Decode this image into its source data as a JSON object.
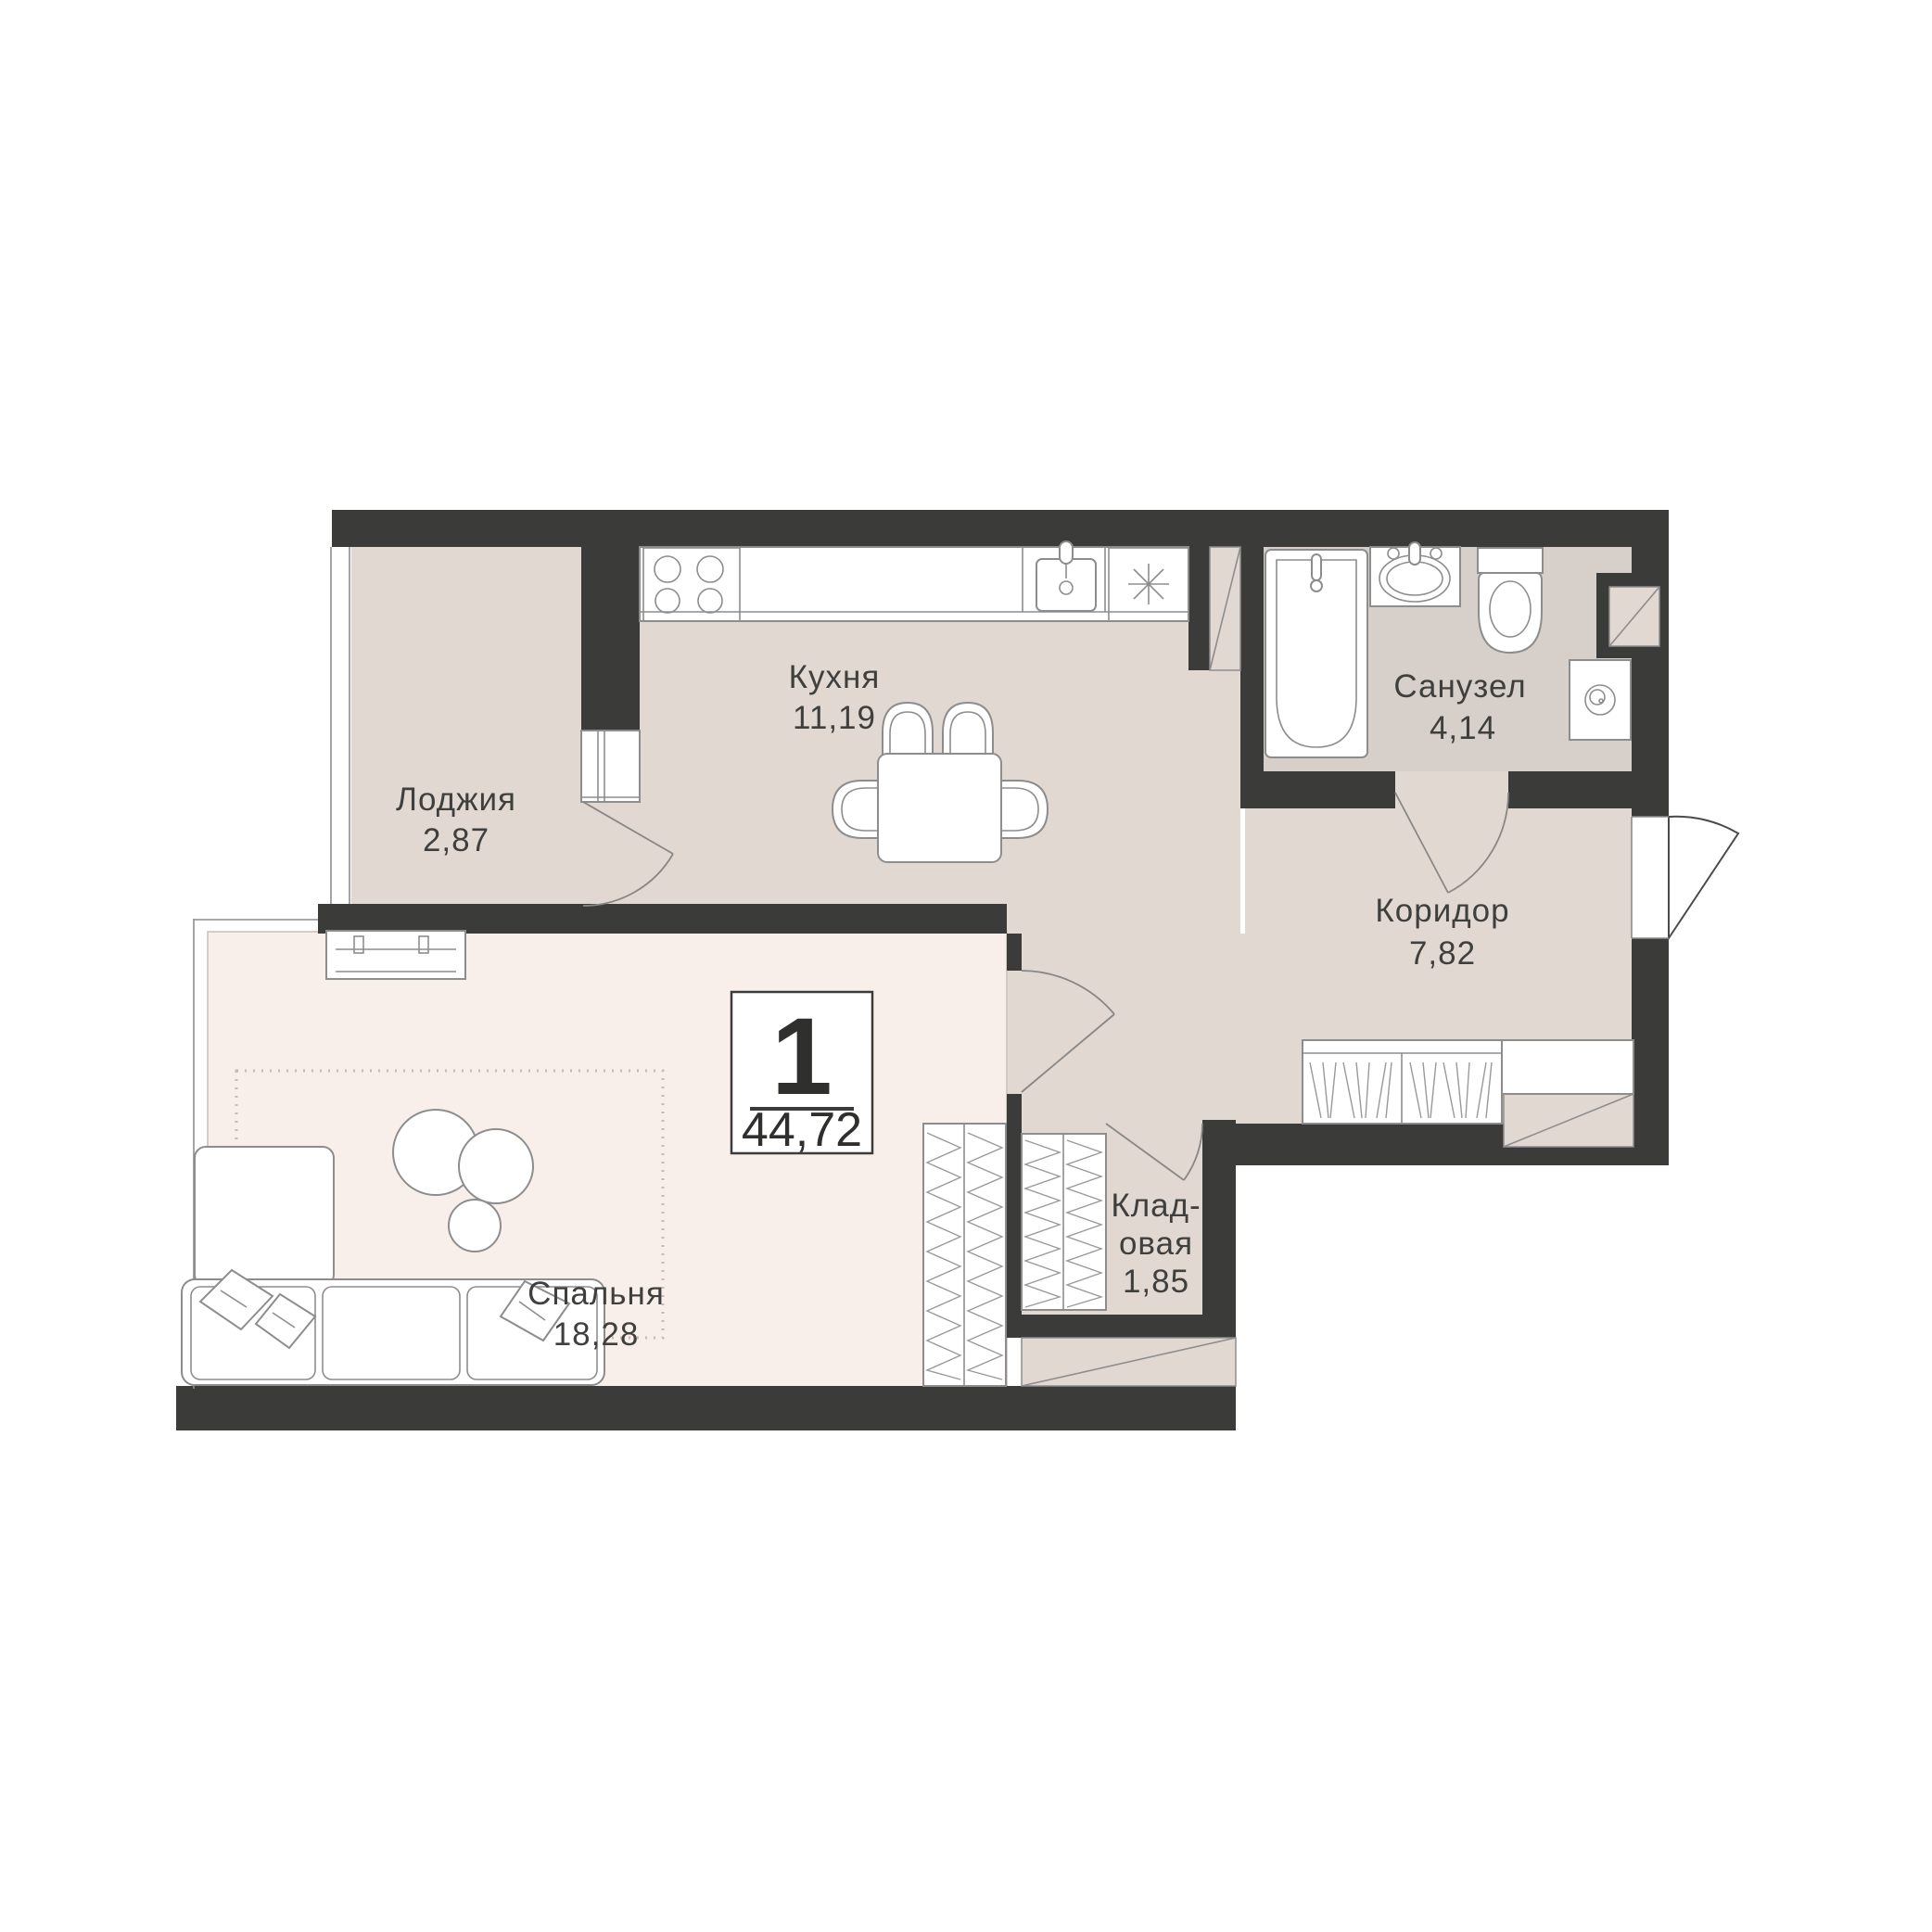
{
  "badge": {
    "room_count": "1",
    "total_area": "44,72"
  },
  "rooms": {
    "kitchen": {
      "label": "Кухня",
      "area": "11,19"
    },
    "loggia": {
      "label": "Лоджия",
      "area": "2,87"
    },
    "bathroom": {
      "label": "Санузел",
      "area": "4,14"
    },
    "corridor": {
      "label": "Коридор",
      "area": "7,82"
    },
    "storage": {
      "label_line1": "Клад-",
      "label_line2": "овая",
      "area": "1,85"
    },
    "bedroom": {
      "label": "Спальня",
      "area": "18,28"
    }
  },
  "colors": {
    "wall": "#3b3b3a",
    "floor_main": "#e2d8d2",
    "floor_bedroom": "#f8efea",
    "floor_bathroom": "#d7d0ca",
    "label_text": "#3f3f3e"
  }
}
